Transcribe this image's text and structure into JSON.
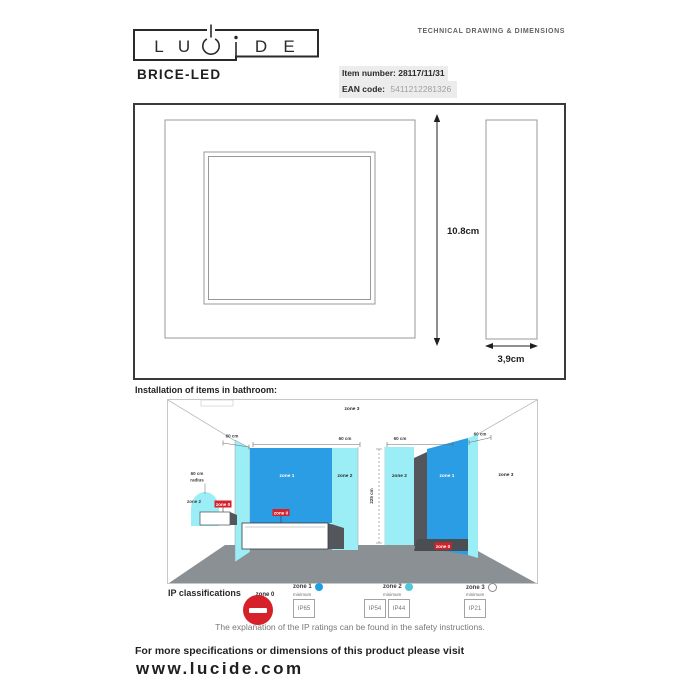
{
  "header": {
    "doc_type": "TECHNICAL DRAWING & DIMENSIONS",
    "product_name": "BRICE-LED",
    "item_label": "Item number:",
    "item_value": "28117/11/31",
    "ean_label": "EAN code:",
    "ean_value": "5411212281326",
    "logo": {
      "text": "LUCIDE",
      "letters": [
        "L",
        "U",
        "C",
        "i",
        "D",
        "E"
      ]
    }
  },
  "drawing": {
    "height_label": "10.8cm",
    "depth_label": "3,9cm"
  },
  "bathroom": {
    "title": "Installation of items in bathroom:",
    "zone0": "zone 0",
    "zone1": "zone 1",
    "zone2": "zone 2",
    "zone3": "zone 3",
    "dim_60": "60 cm",
    "radius_line1": "60 cm",
    "radius_line2": "radius",
    "dim_225": "225 cm"
  },
  "ip": {
    "title": "IP classifications",
    "items": [
      {
        "zone": "zone 0"
      },
      {
        "zone": "zone 1",
        "minimum": "minimum",
        "ratings": [
          "IP65"
        ]
      },
      {
        "zone": "zone 2",
        "minimum": "minimum",
        "ratings": [
          "IP54",
          "IP44"
        ]
      },
      {
        "zone": "zone 3",
        "minimum": "minimum",
        "ratings": [
          "IP21"
        ]
      }
    ],
    "note": "The explanation of the IP ratings can be found in the safety instructions."
  },
  "footer": {
    "line1": "For more specifications or dimensions of this product please visit",
    "url": "www.lucide.com"
  },
  "colors": {
    "zone1_blue": "#2b9de4",
    "zone2_cyan": "#9ceef6",
    "zone0_red": "#d6212b",
    "floor_gray": "#8b9095",
    "ink": "#211e1f"
  }
}
